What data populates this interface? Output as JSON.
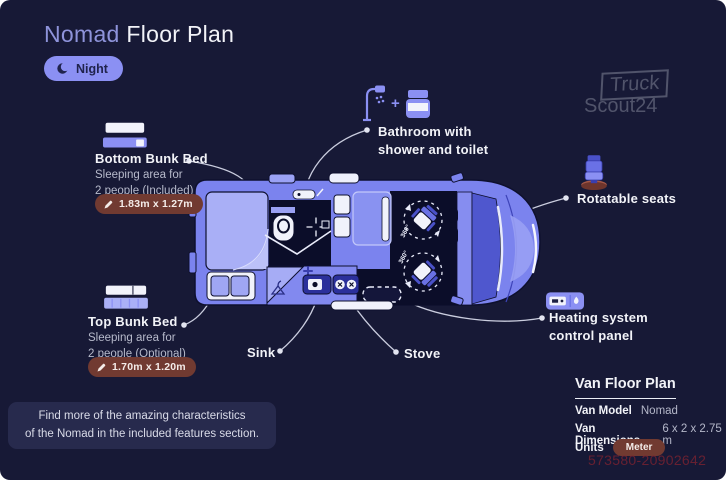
{
  "header": {
    "title_highlight": "Nomad",
    "title_rest": " Floor Plan",
    "night_label": "Night"
  },
  "logo": {
    "line1": "Truck",
    "line2": "Scout24"
  },
  "annotations": {
    "bottom_bunk": {
      "title": "Bottom Bunk Bed",
      "desc_line1": "Sleeping area for",
      "desc_line2": "2 people (Included)",
      "dimensions": "1.83m x 1.27m"
    },
    "top_bunk": {
      "title": "Top Bunk Bed",
      "desc_line1": "Sleeping area for",
      "desc_line2": "2 people (Optional)",
      "dimensions": "1.70m x 1.20m"
    },
    "bathroom": {
      "line1": "Bathroom with",
      "line2": "shower and toilet"
    },
    "rotatable_seats": {
      "label": "Rotatable seats"
    },
    "heating": {
      "line1": "Heating system",
      "line2": "control panel"
    },
    "sink": {
      "label": "Sink"
    },
    "stove": {
      "label": "Stove"
    }
  },
  "floor_plan": {
    "seat_rotation_label": "360°"
  },
  "info_panel": {
    "title": "Van Floor Plan",
    "rows": [
      {
        "label": "Van Model",
        "value": "Nomad"
      },
      {
        "label": "Van Dimensions",
        "value": "6 x 2 x 2.75 m"
      },
      {
        "label": "Units",
        "value": "Meter"
      }
    ]
  },
  "note": {
    "line1": "Find more of the amazing characteristics",
    "line2": "of the Nomad in the included features section."
  },
  "watermark": {
    "text": "573580-20902642"
  },
  "colors": {
    "background": "#171936",
    "accent_periwinkle": "#8b90f3",
    "van_body": "#7b83ee",
    "bed_light": "#a9aff6",
    "dark_interior": "#0b0d29",
    "dimension_pill": "#713a31",
    "text_white": "#f2f3f8",
    "text_gray": "#b7bacb",
    "connector": "#d4d7e8"
  }
}
